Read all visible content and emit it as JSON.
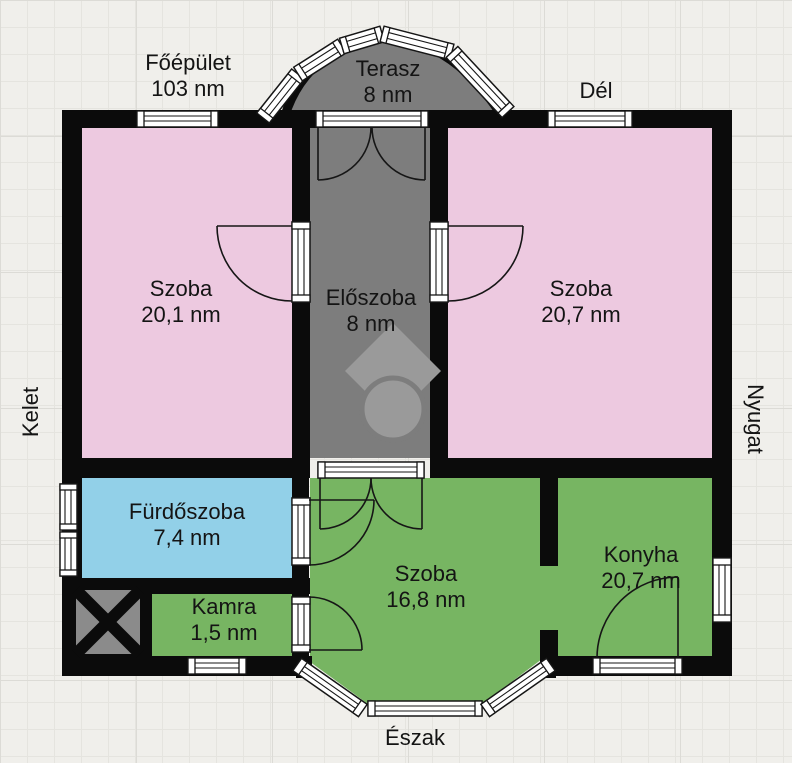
{
  "plan": {
    "building": {
      "label": "Főépület",
      "area": "103 nm"
    },
    "compass": {
      "south": "Dél",
      "north": "Észak",
      "east": "Kelet",
      "west": "Nyugat"
    },
    "palette": {
      "wall": "#0b0b0b",
      "pink": "#edc9e0",
      "green": "#77b562",
      "blue": "#92d0e8",
      "gray": "#7d7d7d",
      "void_hatch": "#8b8b8b",
      "watermark": "#9a9a9a"
    },
    "rooms": [
      {
        "id": "terasz",
        "label": "Terasz",
        "area": "8 nm",
        "color": "#7d7d7d"
      },
      {
        "id": "szoba-bal",
        "label": "Szoba",
        "area": "20,1 nm",
        "color": "#edc9e0"
      },
      {
        "id": "eloszoba",
        "label": "Előszoba",
        "area": "8 nm",
        "color": "#7d7d7d"
      },
      {
        "id": "szoba-jobb",
        "label": "Szoba",
        "area": "20,7 nm",
        "color": "#edc9e0"
      },
      {
        "id": "furdoszoba",
        "label": "Fürdőszoba",
        "area": "7,4 nm",
        "color": "#92d0e8"
      },
      {
        "id": "kamra",
        "label": "Kamra",
        "area": "1,5 nm",
        "color": "#77b562"
      },
      {
        "id": "szoba-also",
        "label": "Szoba",
        "area": "16,8 nm",
        "color": "#77b562"
      },
      {
        "id": "konyha",
        "label": "Konyha",
        "area": "20,7 nm",
        "color": "#77b562"
      }
    ]
  }
}
